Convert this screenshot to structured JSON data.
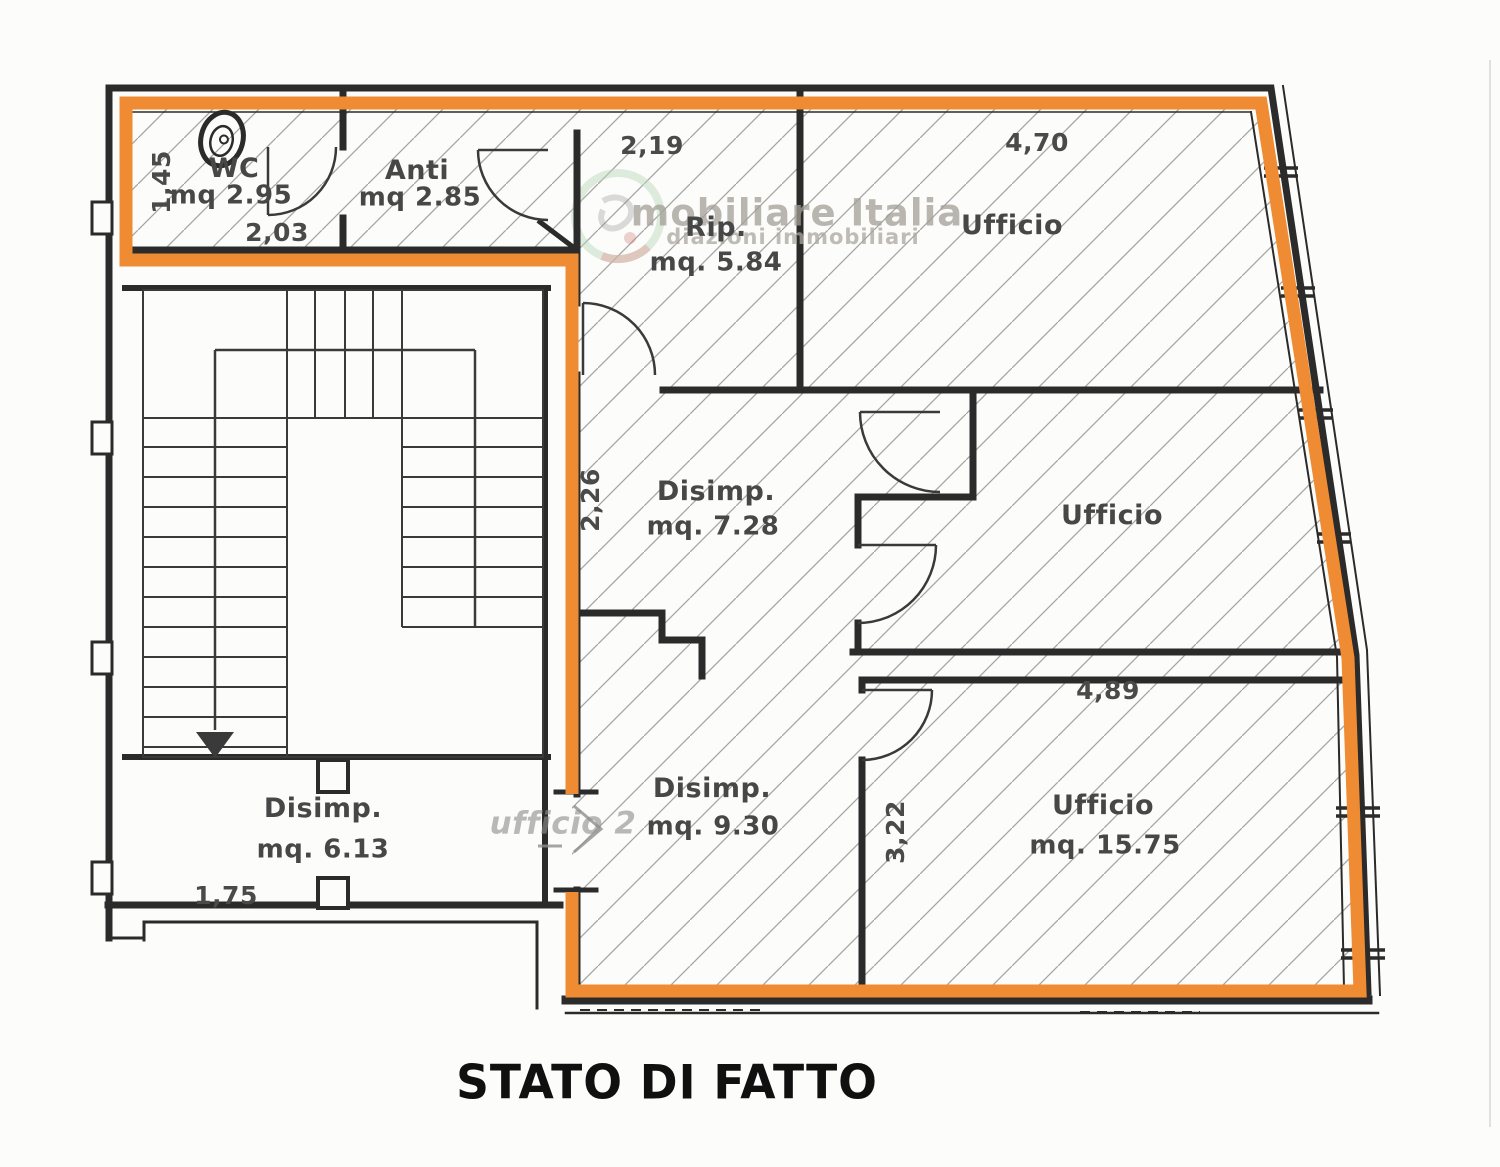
{
  "document": {
    "title": "STATO DI FATTO"
  },
  "watermark": {
    "brand": "mobiliare Italia",
    "tagline": "diazioni immobiliari"
  },
  "handwritten_note": {
    "text": "ufficio 2"
  },
  "rooms": {
    "wc": {
      "name": "WC",
      "area": "mq 2.95"
    },
    "anti": {
      "name": "Anti",
      "area": "mq 2.85"
    },
    "rip": {
      "name": "Rip.",
      "area": "mq. 5.84"
    },
    "ufficio_top": {
      "name": "Ufficio"
    },
    "disimp_center": {
      "name": "Disimp.",
      "area": "mq. 7.28"
    },
    "ufficio_mid": {
      "name": "Ufficio"
    },
    "disimp_lower": {
      "name": "Disimp.",
      "area": "mq. 9.30"
    },
    "ufficio_bottom": {
      "name": "Ufficio",
      "area": "mq. 15.75"
    },
    "disimp_left": {
      "name": "Disimp.",
      "area": "mq. 6.13"
    }
  },
  "dimensions": {
    "wc_height": "1,45",
    "wc_width": "2,03",
    "rip_top": "2,19",
    "ufficio_top_width": "4,70",
    "disimp_center_height": "2,26",
    "ufficio_bottom_top": "4,89",
    "ufficio_bottom_height": "3,22",
    "disimp_left_bottom": "1,75"
  },
  "colors": {
    "highlight_outline": "#ef8c33",
    "wall": "#2b2b2b",
    "label": "#474747",
    "hatch": "#a0a0a0",
    "title": "#101010",
    "watermark_green": "#a7cdaa",
    "watermark_red": "#e0a49e"
  }
}
